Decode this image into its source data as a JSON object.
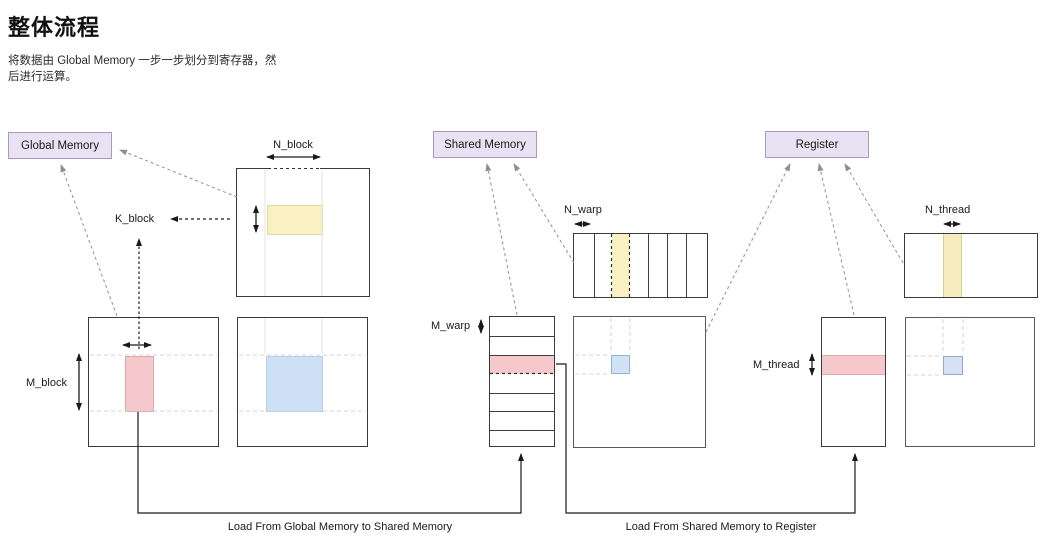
{
  "page": {
    "title": "整体流程",
    "subtitle_line1": "将数据由 Global Memory 一步一步划分到寄存器，然",
    "subtitle_line2": "后进行运算。"
  },
  "memory_labels": {
    "global": "Global Memory",
    "shared": "Shared Memory",
    "register": "Register"
  },
  "dimension_labels": {
    "n_block": "N_block",
    "k_block": "K_block",
    "m_block": "M_block",
    "n_warp": "N_warp",
    "m_warp": "M_warp",
    "n_thread": "N_thread",
    "m_thread": "M_thread"
  },
  "captions": {
    "load_global_to_shared": "Load From Global Memory to Shared Memory",
    "load_shared_to_register": "Load From Shared Memory to Register"
  },
  "colors": {
    "label_fill": "#e9e2f2",
    "label_border": "#a79bc4",
    "yellow_fill": "#faf1c3",
    "yellow_border": "#e5d79b",
    "pink_fill": "#f5c8cb",
    "pink_border": "#e0a6ab",
    "blue_fill": "#cde0f5",
    "blue_border": "#97b6d9",
    "line_black": "#1a1a1a",
    "arrow_gray": "#8f8f8f",
    "guide_gray": "#d6d6d6"
  }
}
